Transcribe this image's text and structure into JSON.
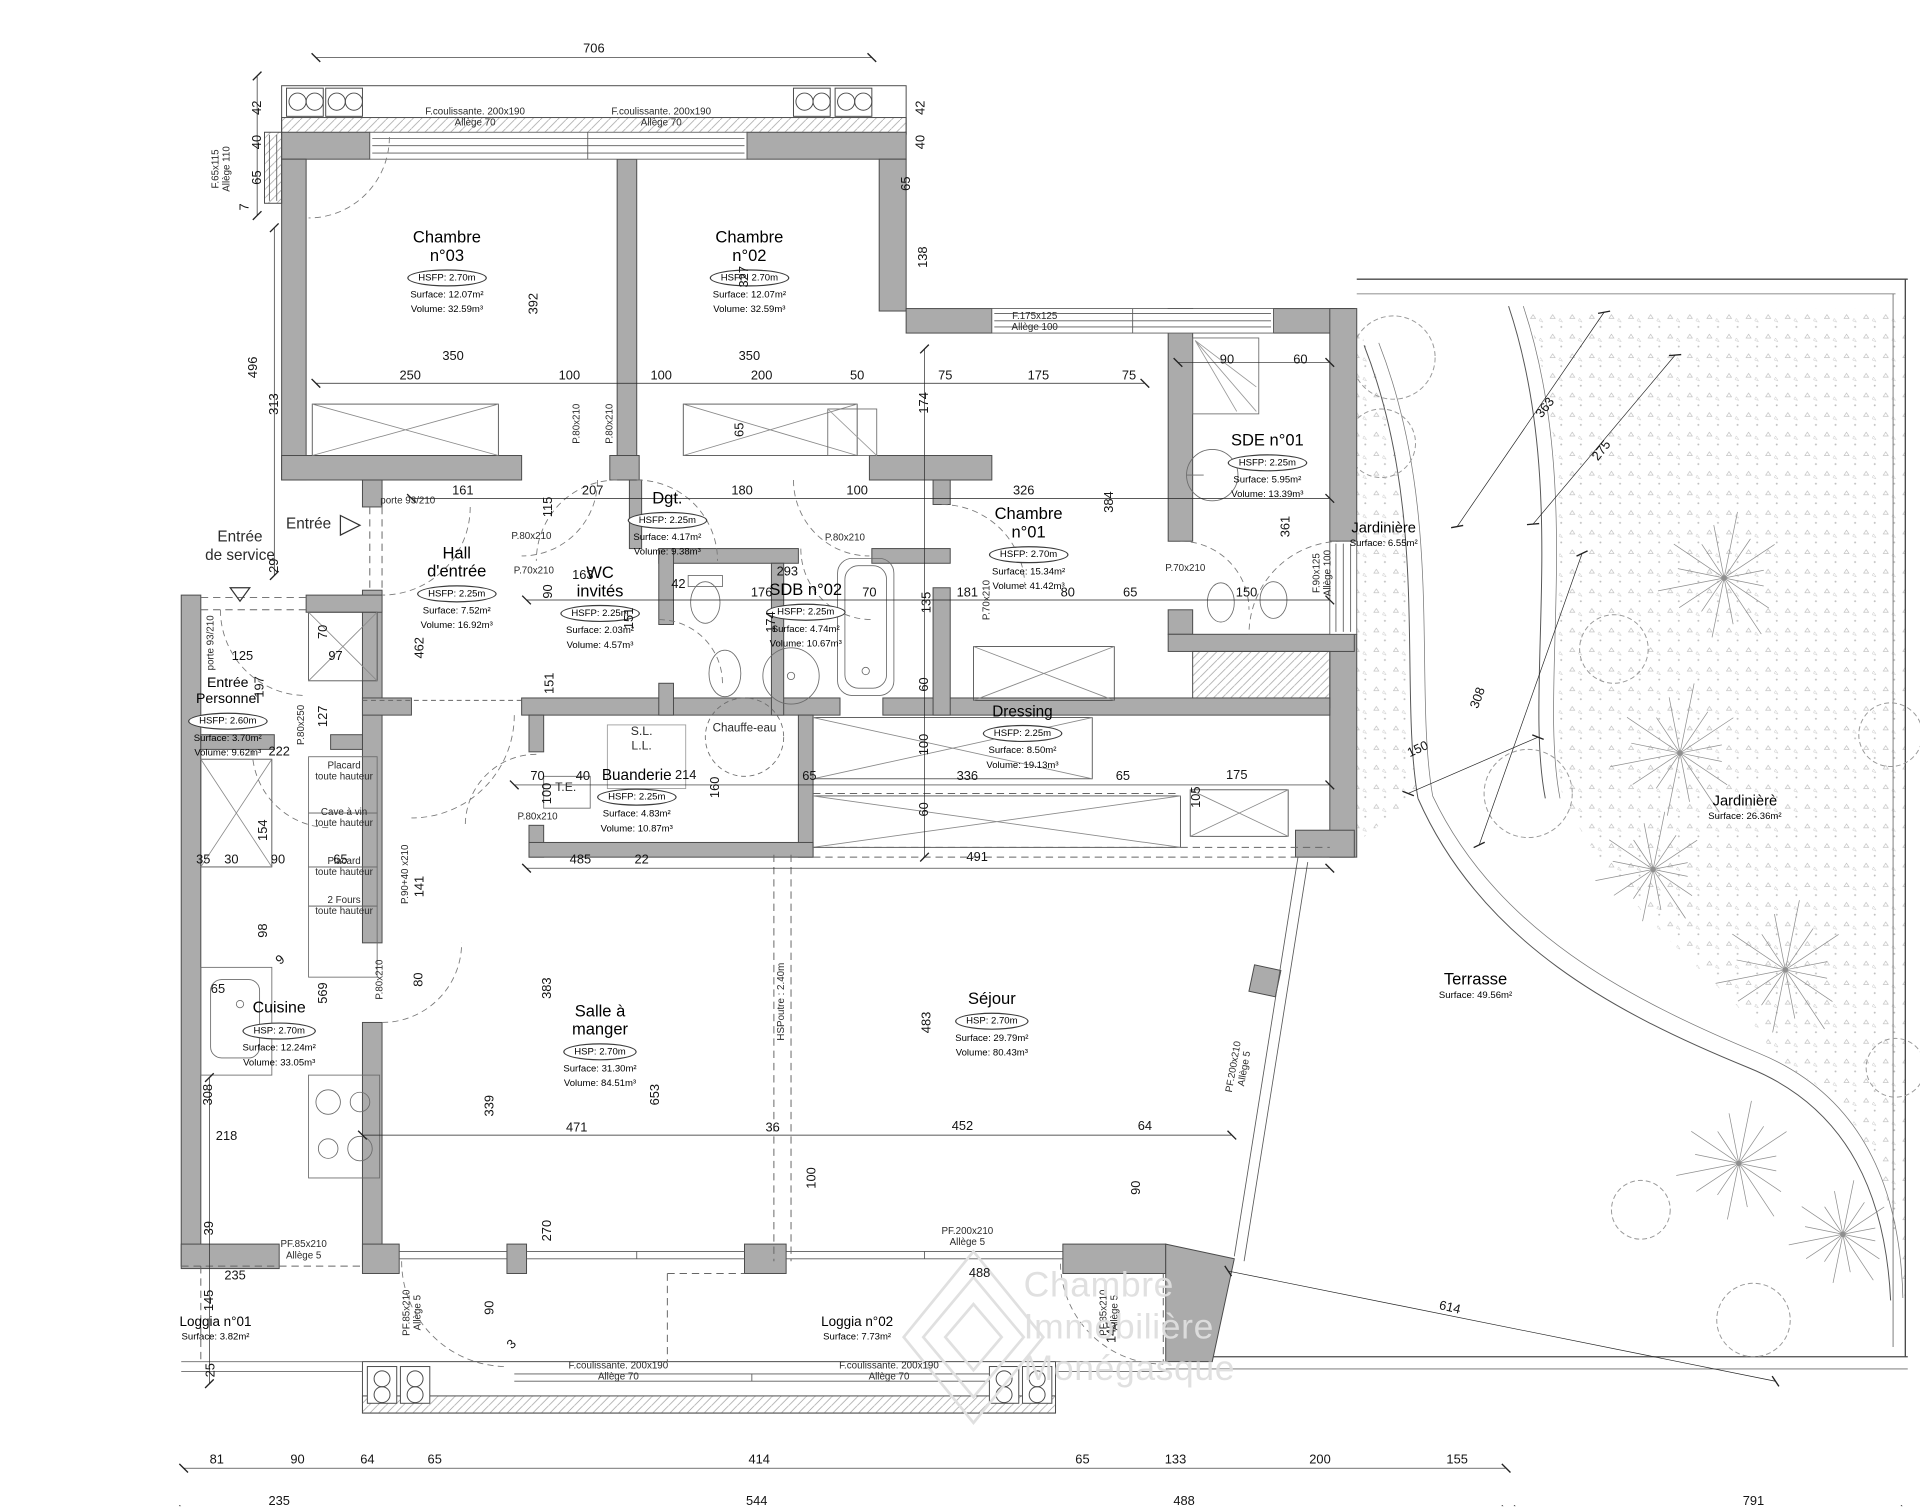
{
  "watermark": {
    "lines": [
      "Chambre",
      "Immobilière",
      "Monégasque"
    ]
  },
  "colors": {
    "wall": "#ababab",
    "line": "#3f3f3f",
    "dim": "#141414",
    "garden": "#8f8f8f",
    "watermark": "#dedede"
  },
  "rooms": [
    {
      "name": "Chambre|n°03",
      "hs": "HSFP: 2.70m",
      "surface": "Surface: 12.07m²",
      "volume": "Volume: 32.59m³",
      "x": 365,
      "y": 186,
      "ns": 13.5
    },
    {
      "name": "Chambre|n°02",
      "hs": "HSFP: 2.70m",
      "surface": "Surface: 12.07m²",
      "volume": "Volume: 32.59m³",
      "x": 612,
      "y": 186,
      "ns": 13.5
    },
    {
      "name": "Chambre|n°01",
      "hs": "HSFP: 2.70m",
      "surface": "Surface: 15.34m²",
      "volume": "Volume: 41.42m³",
      "x": 840,
      "y": 412,
      "ns": 13.5
    },
    {
      "name": "SDE n°01",
      "hs": "HSFP: 2.25m",
      "surface": "Surface: 5.95m²",
      "volume": "Volume: 13.39m³",
      "x": 1035,
      "y": 352,
      "ns": 13.5
    },
    {
      "name": "Dgt.",
      "hs": "HSFP: 2.25m",
      "surface": "Surface: 4.17m²",
      "volume": "Volume: 9.38m³",
      "x": 545,
      "y": 399,
      "ns": 13.5
    },
    {
      "name": "Hall|d'entrée",
      "hs": "HSFP: 2.25m",
      "surface": "Surface: 7.52m²",
      "volume": "Volume: 16.92m³",
      "x": 373,
      "y": 444,
      "ns": 13.5
    },
    {
      "name": "WC|invités",
      "hs": "HSFP: 2.25m",
      "surface": "Surface: 2.03m²",
      "volume": "Volume: 4.57m³",
      "x": 490,
      "y": 460,
      "ns": 13.5
    },
    {
      "name": "SDB n°02",
      "hs": "HSFP: 2.25m",
      "surface": "Surface: 4.74m²",
      "volume": "Volume: 10.67m³",
      "x": 658,
      "y": 474,
      "ns": 13.5
    },
    {
      "name": "Entrée|Personnel",
      "hs": "HSFP: 2.60m",
      "surface": "Surface: 3.70m²",
      "volume": "Volume: 9.62m³",
      "x": 186,
      "y": 552,
      "ns": 11.5
    },
    {
      "name": "Cuisine",
      "hs": "HSP: 2.70m",
      "surface": "Surface: 12.24m²",
      "volume": "Volume: 33.05m³",
      "x": 228,
      "y": 816,
      "ns": 13
    },
    {
      "name": "Buanderie",
      "hs": "HSFP: 2.25m",
      "surface": "Surface: 4.83m²",
      "volume": "Volume: 10.87m³",
      "x": 520,
      "y": 626,
      "ns": 12.5
    },
    {
      "name": "Dressing",
      "hs": "HSFP: 2.25m",
      "surface": "Surface: 8.50m²",
      "volume": "Volume: 19.13m³",
      "x": 835,
      "y": 574,
      "ns": 12.5
    },
    {
      "name": "Salle à|manger",
      "hs": "HSP: 2.70m",
      "surface": "Surface: 31.30m²",
      "volume": "Volume: 84.51m³",
      "x": 490,
      "y": 818,
      "ns": 13.5
    },
    {
      "name": "Séjour",
      "hs": "HSP: 2.70m",
      "surface": "Surface: 29.79m²",
      "volume": "Volume: 80.43m³",
      "x": 810,
      "y": 808,
      "ns": 13.5
    },
    {
      "name": "Terrasse",
      "hs": "",
      "surface": "Surface: 49.56m²",
      "volume": "",
      "x": 1205,
      "y": 792,
      "ns": 13.5
    },
    {
      "name": "Jardinière",
      "hs": "",
      "surface": "Surface: 6.55m²",
      "volume": "",
      "x": 1130,
      "y": 425,
      "ns": 12
    },
    {
      "name": "Jardinièrè",
      "hs": "",
      "surface": "Surface: 26.36m²",
      "volume": "",
      "x": 1425,
      "y": 648,
      "ns": 12
    },
    {
      "name": "Loggia n°01",
      "hs": "",
      "surface": "Surface: 3.82m²",
      "volume": "",
      "x": 176,
      "y": 1074,
      "ns": 11
    },
    {
      "name": "Loggia n°02",
      "hs": "",
      "surface": "Surface: 7.73m²",
      "volume": "",
      "x": 700,
      "y": 1074,
      "ns": 11
    }
  ],
  "annotations": [
    {
      "t": "F.coulissante. 200x190|Allège 70",
      "x": 388,
      "y": 96
    },
    {
      "t": "F.coulissante. 200x190|Allège 70",
      "x": 540,
      "y": 96
    },
    {
      "t": "F.65x115|Allège 110",
      "x": 181,
      "y": 138,
      "r": -90
    },
    {
      "t": "F.175x125|Allège 100",
      "x": 845,
      "y": 263
    },
    {
      "t": "F.90x125|Allège 100",
      "x": 1080,
      "y": 468,
      "r": -90
    },
    {
      "t": "porte 93/210",
      "x": 333,
      "y": 409
    },
    {
      "t": "porte 93/210",
      "x": 172,
      "y": 525,
      "r": -90
    },
    {
      "t": "P.80x210",
      "x": 471,
      "y": 346,
      "r": -90
    },
    {
      "t": "P.80x210",
      "x": 498,
      "y": 346,
      "r": -90
    },
    {
      "t": "P.80x210",
      "x": 434,
      "y": 438
    },
    {
      "t": "P.70x210",
      "x": 436,
      "y": 466
    },
    {
      "t": "P.80x210",
      "x": 690,
      "y": 439
    },
    {
      "t": "P.70x210",
      "x": 806,
      "y": 490,
      "r": -90
    },
    {
      "t": "P.70x210",
      "x": 968,
      "y": 464
    },
    {
      "t": "P.80x250",
      "x": 246,
      "y": 592,
      "r": -90
    },
    {
      "t": "P.80x210",
      "x": 310,
      "y": 800,
      "r": -90
    },
    {
      "t": "P.80x210",
      "x": 439,
      "y": 667
    },
    {
      "t": "P.90+40 x210",
      "x": 331,
      "y": 714,
      "r": -90
    },
    {
      "t": "PF.85x210|Allège 5",
      "x": 248,
      "y": 1021
    },
    {
      "t": "PF.85x210|Allège 5",
      "x": 337,
      "y": 1072,
      "r": -90
    },
    {
      "t": "PF.85x210|Allège 5",
      "x": 906,
      "y": 1072,
      "r": -90
    },
    {
      "t": "PF.200x210|Allège 5",
      "x": 790,
      "y": 1010
    },
    {
      "t": "PF.200x210|Allège 5",
      "x": 1012,
      "y": 872,
      "r": -80
    },
    {
      "t": "F.coulissante. 200x190|Allège 70",
      "x": 505,
      "y": 1120
    },
    {
      "t": "F.coulissante. 200x190|Allège 70",
      "x": 726,
      "y": 1120
    },
    {
      "t": "Placard|toute hauteur",
      "x": 281,
      "y": 630
    },
    {
      "t": "Cave à vin|toute hauteur",
      "x": 281,
      "y": 668
    },
    {
      "t": "Placard|toute hauteur",
      "x": 281,
      "y": 708
    },
    {
      "t": "2 Fours|toute hauteur",
      "x": 281,
      "y": 740
    },
    {
      "t": "T.E.",
      "x": 462,
      "y": 644,
      "s": 10
    },
    {
      "t": "S.L.|L.L.",
      "x": 524,
      "y": 604,
      "s": 10
    },
    {
      "t": "Chauffe-eau",
      "x": 608,
      "y": 595,
      "s": 9.5
    },
    {
      "t": "HSPoutre : 2.40m",
      "x": 638,
      "y": 818,
      "r": -90,
      "s": 8
    },
    {
      "t": "Entrée",
      "x": 252,
      "y": 428,
      "s": 12.5
    },
    {
      "t": "Entrée|de service",
      "x": 196,
      "y": 446,
      "s": 12.5
    }
  ],
  "dimensions": [
    [
      "706",
      485,
      40
    ],
    [
      "42",
      210,
      88,
      -90
    ],
    [
      "40",
      210,
      116,
      -90
    ],
    [
      "65",
      210,
      145,
      -90
    ],
    [
      "7",
      200,
      169,
      -90
    ],
    [
      "496",
      207,
      300,
      -90
    ],
    [
      "313",
      224,
      330,
      -90
    ],
    [
      "29",
      224,
      462,
      -90
    ],
    [
      "42",
      752,
      88,
      -90
    ],
    [
      "40",
      752,
      116,
      -90
    ],
    [
      "65",
      740,
      150,
      -90
    ],
    [
      "138",
      754,
      210,
      -90
    ],
    [
      "327",
      608,
      226,
      -90
    ],
    [
      "392",
      436,
      248,
      -90
    ],
    [
      "350",
      370,
      291
    ],
    [
      "350",
      612,
      291
    ],
    [
      "250",
      335,
      307
    ],
    [
      "100",
      465,
      307
    ],
    [
      "100",
      540,
      307
    ],
    [
      "200",
      622,
      307
    ],
    [
      "50",
      700,
      307
    ],
    [
      "75",
      772,
      307
    ],
    [
      "175",
      848,
      307
    ],
    [
      "75",
      922,
      307
    ],
    [
      "90",
      1002,
      294
    ],
    [
      "60",
      1062,
      294
    ],
    [
      "65",
      604,
      351,
      -90
    ],
    [
      "174",
      755,
      329,
      -90
    ],
    [
      "161",
      378,
      401
    ],
    [
      "207",
      484,
      401
    ],
    [
      "180",
      606,
      401
    ],
    [
      "100",
      700,
      401
    ],
    [
      "326",
      836,
      401
    ],
    [
      "384",
      906,
      410,
      -90
    ],
    [
      "115",
      448,
      414,
      -90
    ],
    [
      "90",
      448,
      483,
      -90
    ],
    [
      "163",
      476,
      470
    ],
    [
      "42",
      554,
      477
    ],
    [
      "293",
      643,
      467
    ],
    [
      "176",
      622,
      484
    ],
    [
      "70",
      710,
      484
    ],
    [
      "181",
      790,
      484
    ],
    [
      "80",
      872,
      484
    ],
    [
      "65",
      923,
      484
    ],
    [
      "150",
      1018,
      484
    ],
    [
      "135",
      757,
      492,
      -90
    ],
    [
      "151",
      514,
      505,
      -90
    ],
    [
      "151",
      449,
      558,
      -90
    ],
    [
      "174",
      630,
      508,
      -90
    ],
    [
      "361",
      1050,
      430,
      -90
    ],
    [
      "462",
      343,
      529,
      -90
    ],
    [
      "70",
      264,
      516,
      -90
    ],
    [
      "125",
      198,
      536
    ],
    [
      "97",
      274,
      536
    ],
    [
      "197",
      212,
      561,
      -90
    ],
    [
      "127",
      264,
      585,
      -90
    ],
    [
      "222",
      228,
      614
    ],
    [
      "154",
      215,
      678,
      -90
    ],
    [
      "35",
      166,
      702
    ],
    [
      "30",
      189,
      702
    ],
    [
      "90",
      227,
      702
    ],
    [
      "65",
      278,
      702
    ],
    [
      "98",
      215,
      760,
      -90
    ],
    [
      "9",
      229,
      784,
      -40
    ],
    [
      "65",
      178,
      808
    ],
    [
      "569",
      264,
      811,
      -90
    ],
    [
      "308",
      170,
      894,
      -90
    ],
    [
      "218",
      185,
      928
    ],
    [
      "39",
      171,
      1003,
      -90
    ],
    [
      "235",
      192,
      1042
    ],
    [
      "145",
      171,
      1062,
      -90
    ],
    [
      "25",
      172,
      1119,
      -90
    ],
    [
      "141",
      343,
      724,
      -90
    ],
    [
      "80",
      342,
      800,
      -90
    ],
    [
      "70",
      439,
      634
    ],
    [
      "40",
      476,
      634
    ],
    [
      "214",
      560,
      633
    ],
    [
      "160",
      584,
      643,
      -90
    ],
    [
      "65",
      661,
      634
    ],
    [
      "336",
      790,
      634
    ],
    [
      "65",
      917,
      634
    ],
    [
      "175",
      1010,
      633
    ],
    [
      "105",
      977,
      651,
      -90
    ],
    [
      "100",
      447,
      648,
      -90
    ],
    [
      "60",
      755,
      559,
      -90
    ],
    [
      "100",
      755,
      608,
      -90
    ],
    [
      "60",
      755,
      661,
      -90
    ],
    [
      "485",
      474,
      702
    ],
    [
      "22",
      524,
      702
    ],
    [
      "491",
      798,
      700
    ],
    [
      "383",
      447,
      807,
      -90
    ],
    [
      "653",
      535,
      894,
      -90
    ],
    [
      "339",
      400,
      903,
      -90
    ],
    [
      "270",
      447,
      1005,
      -90
    ],
    [
      "471",
      471,
      921
    ],
    [
      "36",
      631,
      921
    ],
    [
      "452",
      786,
      920
    ],
    [
      "64",
      935,
      920
    ],
    [
      "483",
      757,
      835,
      -90
    ],
    [
      "100",
      663,
      962,
      -90
    ],
    [
      "90",
      928,
      970,
      -90
    ],
    [
      "90",
      400,
      1068,
      -90
    ],
    [
      "3",
      418,
      1098,
      -45
    ],
    [
      "145",
      908,
      1088,
      -90
    ],
    [
      "488",
      800,
      1040
    ],
    [
      "614",
      1184,
      1068,
      13
    ],
    [
      "308",
      1207,
      570,
      -70
    ],
    [
      "150",
      1158,
      612,
      -25
    ],
    [
      "363",
      1262,
      333,
      -52
    ],
    [
      "275",
      1308,
      368,
      -52
    ],
    [
      "81",
      177,
      1192
    ],
    [
      "90",
      243,
      1192
    ],
    [
      "64",
      300,
      1192
    ],
    [
      "65",
      355,
      1192
    ],
    [
      "414",
      620,
      1192
    ],
    [
      "65",
      884,
      1192
    ],
    [
      "133",
      960,
      1192
    ],
    [
      "200",
      1078,
      1192
    ],
    [
      "155",
      1190,
      1192
    ],
    [
      "235",
      228,
      1226
    ],
    [
      "544",
      618,
      1226
    ],
    [
      "488",
      967,
      1226
    ],
    [
      "791",
      1432,
      1226
    ]
  ]
}
